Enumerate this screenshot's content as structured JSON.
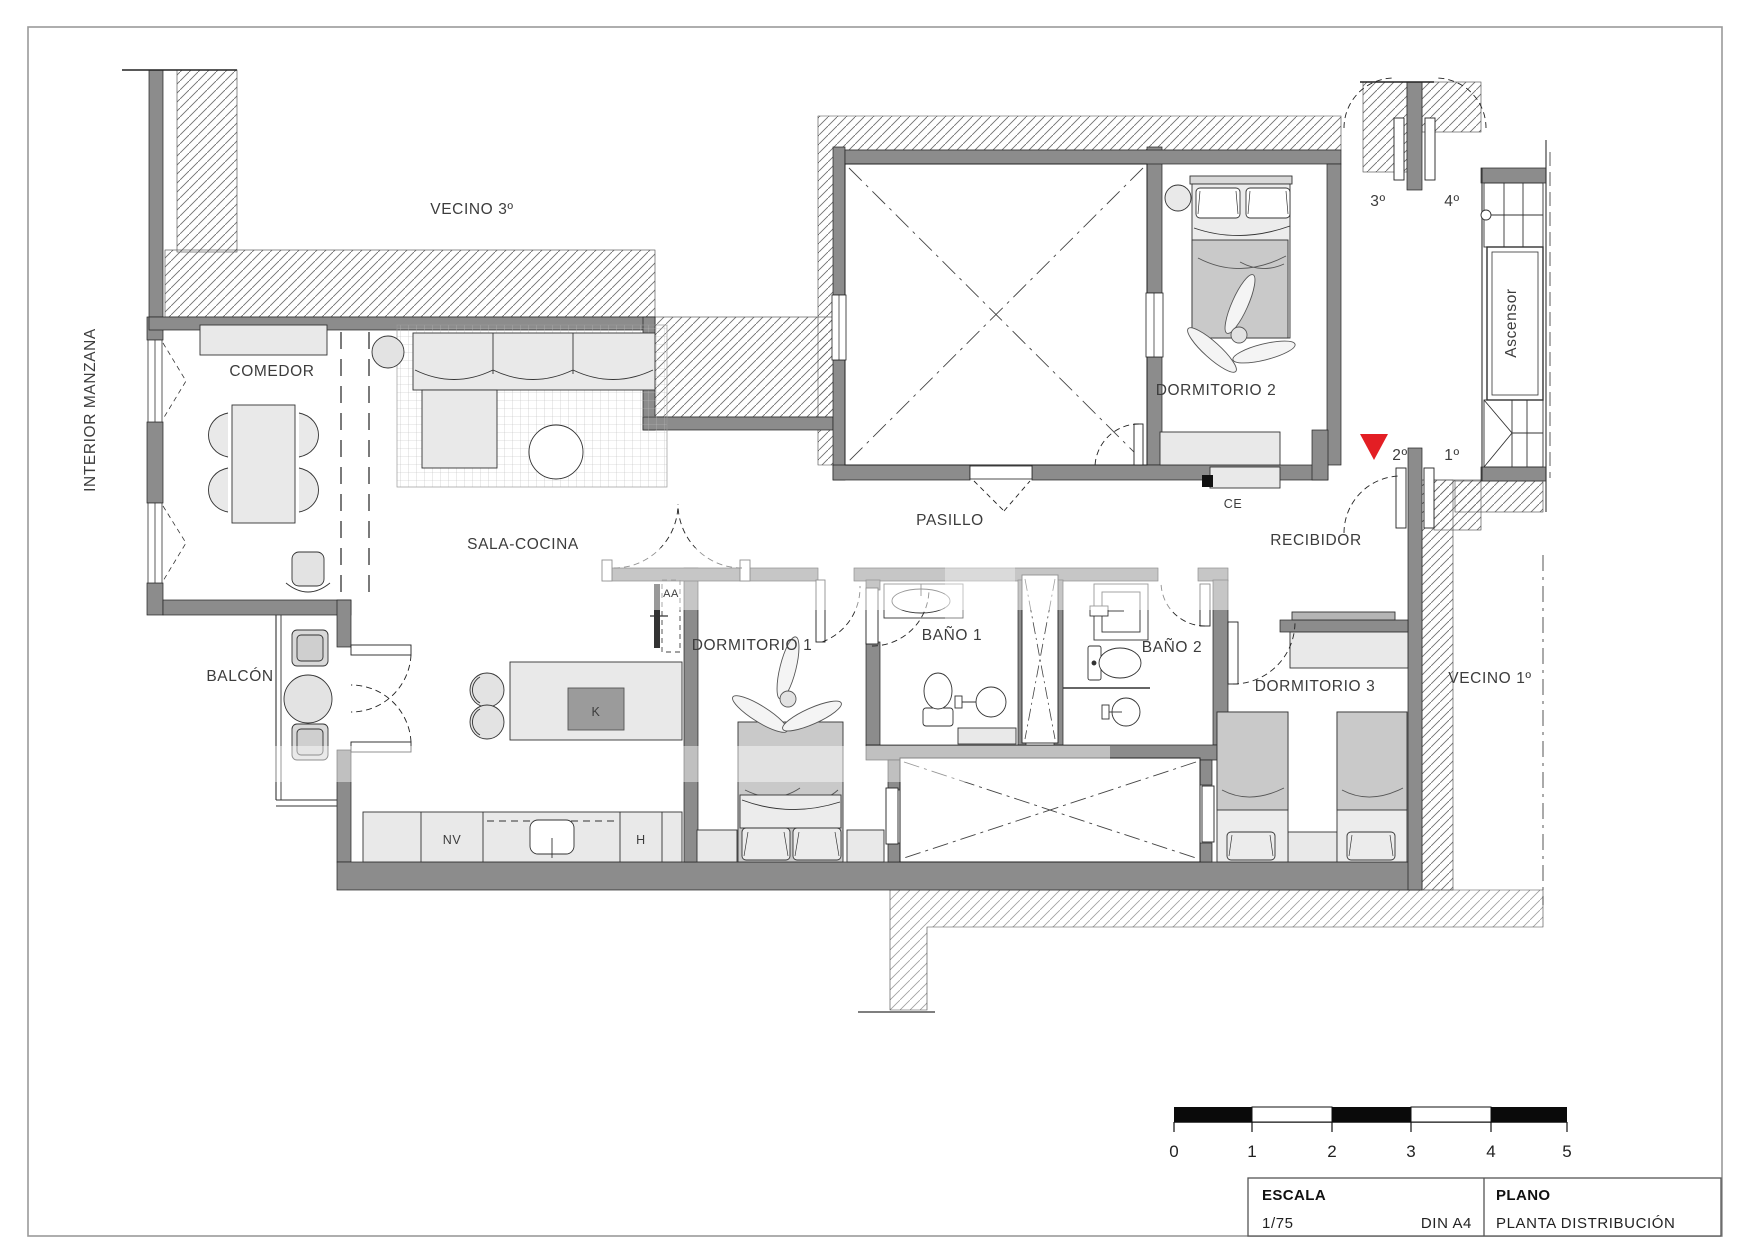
{
  "page": {
    "background": "#ffffff",
    "border_color": "#9a9a9a"
  },
  "colors": {
    "wall": "#8c8c8c",
    "furniture_light": "#e9e9e9",
    "furniture_mid": "#c9c9c9",
    "line": "#2a2a2a",
    "marker_red": "#e31e24"
  },
  "labels": {
    "neighbor_top": "VECINO 3º",
    "neighbor_bottom": "VECINO 1º",
    "interior_block": "INTERIOR MANZANA",
    "dining": "COMEDOR",
    "living_kitchen": "SALA-COCINA",
    "balcony": "BALCÓN",
    "bedroom1": "DORMITORIO 1",
    "bedroom2": "DORMITORIO 2",
    "bedroom3": "DORMITORIO 3",
    "bath1": "BAÑO 1",
    "bath2": "BAÑO 2",
    "hallway": "PASILLO",
    "entry_hall": "RECIBIDOR",
    "elevator": "Ascensor",
    "floor_3": "3º",
    "floor_4": "4º",
    "floor_2": "2º",
    "floor_1": "1º",
    "electrical": "CE",
    "ac_unit": "AA",
    "kitchen_island": "K",
    "fridge": "NV",
    "oven": "H"
  },
  "scale_bar": {
    "ticks": [
      "0",
      "1",
      "2",
      "3",
      "4",
      "5"
    ]
  },
  "title_block": {
    "scale_heading": "ESCALA",
    "scale_value": "1/75",
    "paper": "DIN A4",
    "plan_heading": "PLANO",
    "plan_value": "PLANTA DISTRIBUCIÓN"
  }
}
